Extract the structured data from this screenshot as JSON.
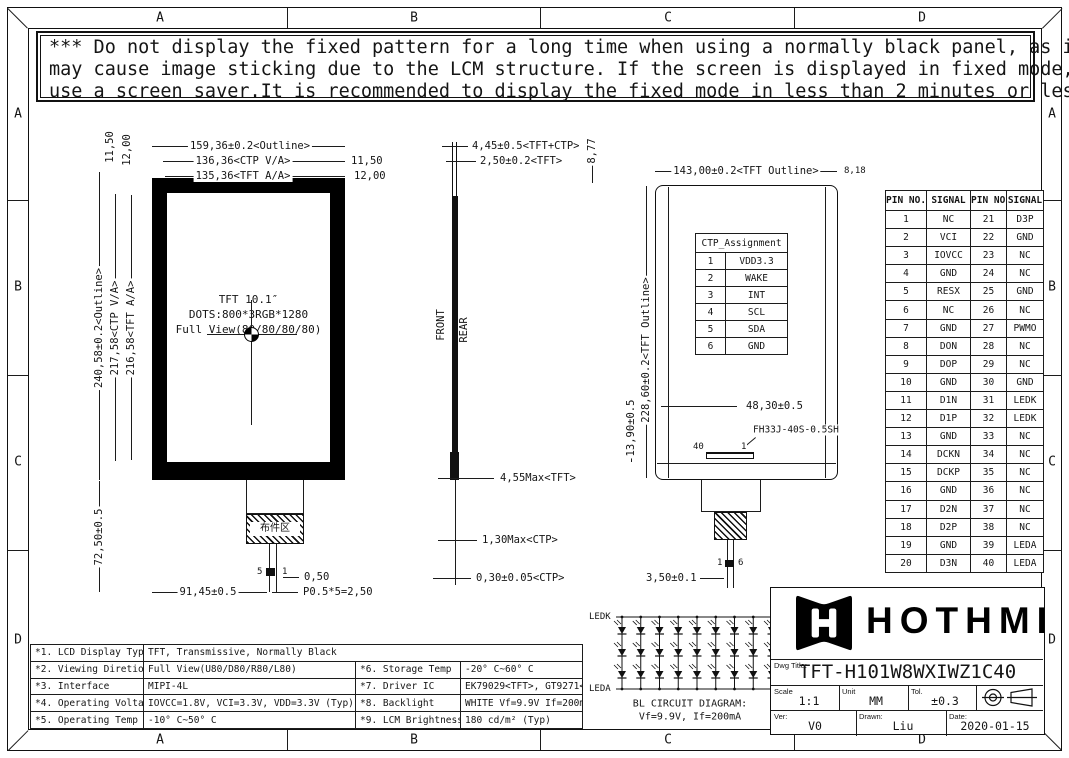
{
  "sheet": {
    "col_labels": [
      "A",
      "B",
      "C",
      "D"
    ],
    "row_labels": [
      "A",
      "B",
      "C",
      "D"
    ]
  },
  "warning": {
    "line1": "*** Do not display the fixed pattern for a long time when using a normally black panel, as it",
    "line2": " may cause image sticking due to the LCM structure. If the screen is displayed in fixed mode,",
    "line3": " use a screen saver.It is recommended to display the fixed mode in less than 2 minutes or less."
  },
  "front_view": {
    "center_line1": "TFT 10.1″",
    "center_line2": "DOTS:800*3RGB*1280",
    "center_line3": "Full View(80/80/80/80)",
    "dim_outline_w": "159,36±0.2<Outline>",
    "dim_ctp_w": "136,36<CTP V/A>",
    "dim_tft_w": "135,36<TFT A/A>",
    "dim_right_offset1": "11,50",
    "dim_right_offset2": "12,00",
    "dim_left_offset1": "11,50",
    "dim_left_offset2": "12,00",
    "dim_outline_h": "240,58±0.2<Outline>",
    "dim_ctp_h": "217,58<CTP V/A>",
    "dim_tft_h": "216,58<TFT A/A>",
    "dim_tail_h": "72,50±0.5",
    "dim_fpc_x": "91,45±0.5",
    "dim_pin_w": "0,50",
    "dim_pitch": "P0.5*5=2,50",
    "pin_label_5": "5",
    "pin_label_1": "1",
    "component_area_label": "布件区"
  },
  "side_view": {
    "front_label": "FRONT",
    "rear_label": "REAR",
    "dim_total": "4,45±0.5<TFT+CTP>",
    "dim_tft": "2,50±0.2<TFT>",
    "dim_tft_max": "4,55Max<TFT>",
    "dim_ctp_max": "1,30Max<CTP>",
    "dim_ctp": "0,30±0.05<CTP>"
  },
  "rear_view": {
    "dim_top_offset": "8,77",
    "dim_outline_w": "143,00±0.2<TFT Outline>",
    "dim_right_offset": "8,18",
    "dim_outline_h": "228,60±0.2<TFT Outline>",
    "dim_fpc_h": "13,90±0.5",
    "dim_conn_x": "48,30±0.5",
    "connector_name": "FH33J-40S-0.5SH",
    "pin_label_40": "40",
    "pin_label_1": "1",
    "cable_pin_1": "1",
    "cable_pin_6": "6",
    "dim_cable_w": "3,50±0.1",
    "ctp_table": {
      "title": "CTP_Assignment",
      "rows": [
        [
          "1",
          "VDD3.3"
        ],
        [
          "2",
          "WAKE"
        ],
        [
          "3",
          "INT"
        ],
        [
          "4",
          "SCL"
        ],
        [
          "5",
          "SDA"
        ],
        [
          "6",
          "GND"
        ]
      ]
    }
  },
  "pin_table": {
    "headers": [
      "PIN NO.",
      "SIGNAL",
      "PIN NO.",
      "SIGNAL"
    ],
    "rows": [
      [
        "1",
        "NC",
        "21",
        "D3P"
      ],
      [
        "2",
        "VCI",
        "22",
        "GND"
      ],
      [
        "3",
        "IOVCC",
        "23",
        "NC"
      ],
      [
        "4",
        "GND",
        "24",
        "NC"
      ],
      [
        "5",
        "RESX",
        "25",
        "GND"
      ],
      [
        "6",
        "NC",
        "26",
        "NC"
      ],
      [
        "7",
        "GND",
        "27",
        "PWMO"
      ],
      [
        "8",
        "DON",
        "28",
        "NC"
      ],
      [
        "9",
        "DOP",
        "29",
        "NC"
      ],
      [
        "10",
        "GND",
        "30",
        "GND"
      ],
      [
        "11",
        "D1N",
        "31",
        "LEDK"
      ],
      [
        "12",
        "D1P",
        "32",
        "LEDK"
      ],
      [
        "13",
        "GND",
        "33",
        "NC"
      ],
      [
        "14",
        "DCKN",
        "34",
        "NC"
      ],
      [
        "15",
        "DCKP",
        "35",
        "NC"
      ],
      [
        "16",
        "GND",
        "36",
        "NC"
      ],
      [
        "17",
        "D2N",
        "37",
        "NC"
      ],
      [
        "18",
        "D2P",
        "38",
        "NC"
      ],
      [
        "19",
        "GND",
        "39",
        "LEDA"
      ],
      [
        "20",
        "D3N",
        "40",
        "LEDA"
      ]
    ]
  },
  "spec_table": {
    "row1": {
      "label": "*1. LCD Display Type",
      "value": "TFT, Transmissive, Normally Black"
    },
    "left_rows": [
      {
        "label": "*2. Viewing Diretion",
        "value": "Full View(U80/D80/R80/L80)"
      },
      {
        "label": "*3. Interface",
        "value": "MIPI-4L"
      },
      {
        "label": "*4. Operating Voltage",
        "value": "IOVCC=1.8V, VCI=3.3V, VDD=3.3V (Typ)"
      },
      {
        "label": "*5. Operating Temp",
        "value": "-10° C~50° C"
      }
    ],
    "right_rows": [
      {
        "label": "*6. Storage Temp",
        "value": "-20° C~60° C"
      },
      {
        "label": "*7. Driver IC",
        "value": "EK79029<TFT>, GT9271<CTP>"
      },
      {
        "label": "*8. Backlight",
        "value": "WHITE Vf=9.9V If=200mA(Typ)"
      },
      {
        "label": "*9. LCM Brightness",
        "value": "180 cd/m² (Typ)"
      }
    ]
  },
  "bl_circuit": {
    "top_label": "LEDK",
    "bottom_label": "LEDA",
    "caption1": "BL CIRCUIT DIAGRAM:",
    "caption2": "Vf=9.9V, If=200mA",
    "strings": 9,
    "leds_per_string": 3
  },
  "title_block": {
    "brand": "HOTHMI",
    "dwg_title_label": "Dwg Title:",
    "dwg_title": "TFT-H101W8WXIWZ1C40",
    "scale_label": "Scale",
    "scale": "1:1",
    "unit_label": "Unit",
    "unit": "MM",
    "tol_label": "Tol.",
    "tol": "±0.3",
    "ver_label": "Ver:",
    "ver": "V0",
    "drawn_label": "Drawn:",
    "drawn": "Liu",
    "date_label": "Date:",
    "date": "2020-01-15"
  }
}
